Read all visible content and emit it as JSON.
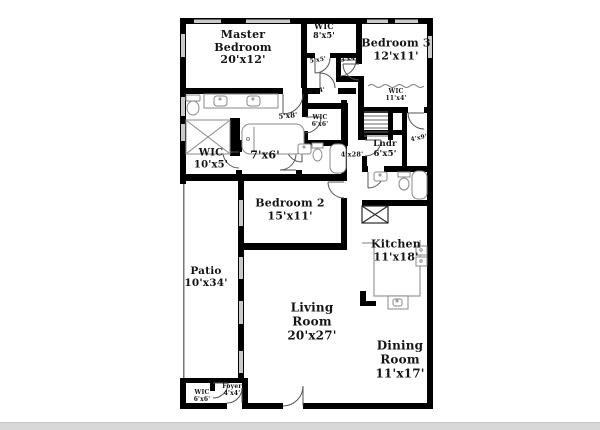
{
  "colors": {
    "wall": "#000000",
    "window": "#c9c9c9",
    "fixture": "#8a8a8a",
    "door": "#555555",
    "thinline": "#777777",
    "text": "#141414",
    "bottom_bar": "#d8d8d8"
  },
  "floorplan": {
    "rooms": [
      {
        "name": "Master Bedroom",
        "dims": "20'x12'"
      },
      {
        "name": "WIC",
        "dims": "8'x5'"
      },
      {
        "name": "Bedroom 3",
        "dims": "12'x11'"
      },
      {
        "name": "WIC",
        "dims": "11'x4'"
      },
      {
        "name": "WIC",
        "dims": "6'x6'"
      },
      {
        "name": "WIC",
        "dims": "10'x5'"
      },
      {
        "name": "Lndr",
        "dims": "6'x5'"
      },
      {
        "name": "Bedroom 2",
        "dims": "15'x11'"
      },
      {
        "name": "Kitchen",
        "dims": "11'x18'"
      },
      {
        "name": "Patio",
        "dims": "10'x34'"
      },
      {
        "name": "Living Room",
        "dims": "20'x27'"
      },
      {
        "name": "Dining Room",
        "dims": "11'x17'"
      },
      {
        "name": "WIC",
        "dims": "6'x6'"
      },
      {
        "name": "Foyer",
        "dims": "4'x4'"
      }
    ],
    "dimension_labels": [
      "5'x5'",
      "3'x4'",
      "6'x4'",
      "5'x8'",
      "7'x6'",
      "4'x9'",
      "4'x28'"
    ]
  }
}
